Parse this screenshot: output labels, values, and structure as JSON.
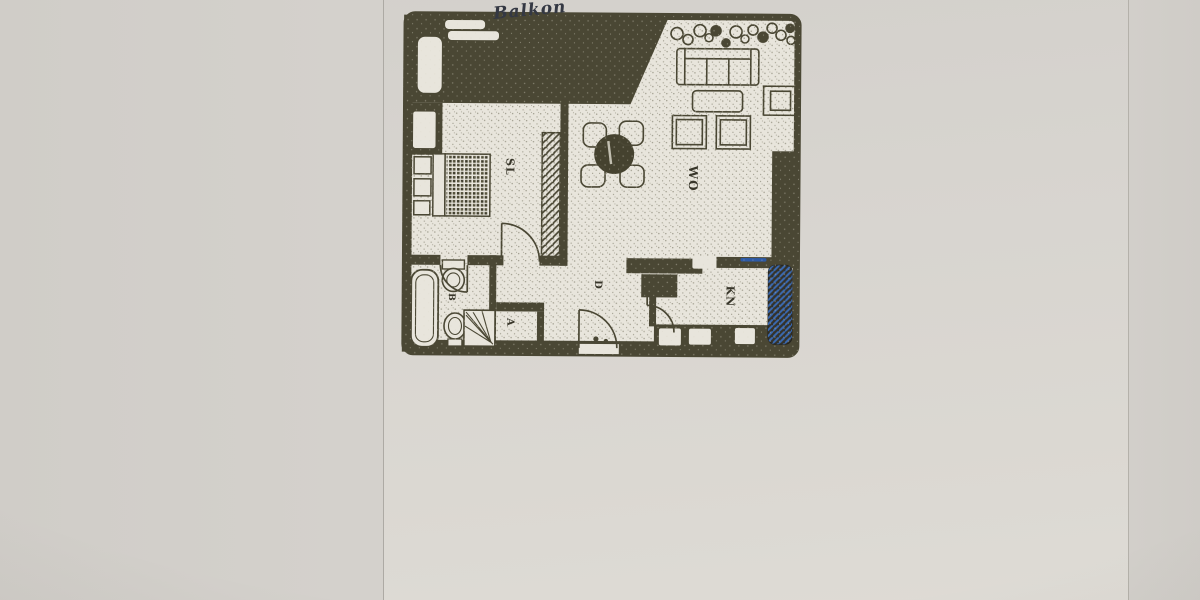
{
  "photo": {
    "annotation": "Balkon"
  },
  "floorplan": {
    "rooms": [
      {
        "id": "sl",
        "label": "SL"
      },
      {
        "id": "wo",
        "label": "WO"
      },
      {
        "id": "kn",
        "label": "KN"
      },
      {
        "id": "b",
        "label": "B"
      },
      {
        "id": "d",
        "label": "D"
      },
      {
        "id": "a",
        "label": "A"
      }
    ],
    "colors": {
      "ink": "#4a4734",
      "plan_paper": "#e8e5dc",
      "photo_paper": "#d6d3ce",
      "pen_blue": "#2d5aa6"
    }
  }
}
